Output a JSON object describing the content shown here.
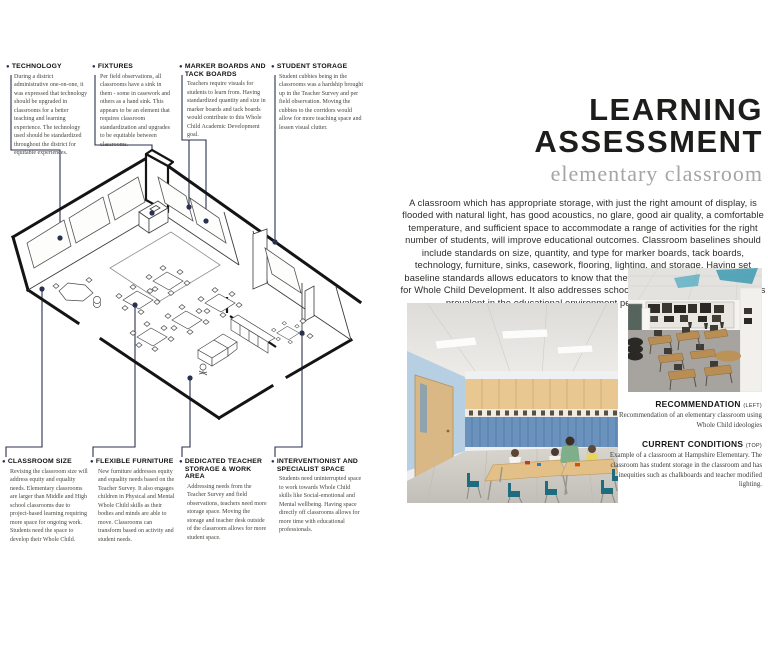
{
  "glyphs": {
    "bullet": "●"
  },
  "colors": {
    "accent_navy": "#2a3150",
    "title_black": "#1d1d1b",
    "subtitle_gray": "#a5a5a2",
    "locker_blue": "#6a92bd",
    "cabinet_wood": "#e8c890",
    "chair_teal": "#1f6b80"
  },
  "header": {
    "title_line1": "LEARNING",
    "title_line2": "ASSESSMENT",
    "subtitle": "elementary classroom"
  },
  "intro": {
    "text": "A classroom which has appropriate storage, with just the right amount of display, is flooded with natural light, has good acoustics, no glare, good air quality, a comfortable temperature, and sufficient space to accommodate a range of activities for the right number of students, will improve educational outcomes. Classroom baselines should include standards on size, quantity, and type for marker boards, tack boards, technology, furniture, sinks, casework, flooring, lighting, and storage. Having set baseline standards allows educators to know that they will have the space necessary for Whole Child Development. It also addresses school wide equity and equality issues prevalent in the educational environment per the Teacher Survey."
  },
  "diagram": {
    "top_callouts": [
      {
        "title": "TECHNOLOGY",
        "body": "During a district administrative one-on-one, it was expressed that technology should be upgraded in classrooms for a better teaching and learning experience. The technology used should be standardized throughout the district for equitable experiences."
      },
      {
        "title": "FIXTURES",
        "body": "Per field observations, all classrooms have a sink in them - some in casework and others as a hand sink. This appears to be an element that requires classroom standardization and upgrades to be equitable between classrooms."
      },
      {
        "title": "MARKER BOARDS AND TACK BOARDS",
        "body": "Teachers require visuals for students to learn from. Having standardized quantity and size in marker boards and tack boards would contribute to this Whole Child Academic Development goal."
      },
      {
        "title": "STUDENT STORAGE",
        "body": "Student cubbies being in the classrooms was a hardship brought up in the Teacher Survey and per field observation. Moving the cubbies to the corridors would allow for more teaching space and lessen visual clutter."
      }
    ],
    "bottom_callouts": [
      {
        "title": "CLASSROOM SIZE",
        "body": "Revising the classroom size will address equity and equality needs. Elementary classrooms are larger than Middle and High school classrooms due to project-based learning requiring more space for ongoing work. Students need the space to develop their Whole Child."
      },
      {
        "title": "FLEXIBLE FURNITURE",
        "body": "New furniture addresses equity and equality needs based on the Teacher Survey. It also engages children in Physical and Mental Whole Child skills as their bodies and minds are able to move. Classrooms can transform based on activity and student needs."
      },
      {
        "title": "DEDICATED TEACHER STORAGE & WORK AREA",
        "body": "Addressing needs from the Teacher Survey and field observations, teachers need more storage space. Moving the storage and teacher desk outside of the classroom allows for more student space."
      },
      {
        "title": "INTERVENTIONIST AND SPECIALIST SPACE",
        "body": "Students need uninterrupted space to work towards Whole Child skills like Social-emotional and Mental wellbeing. Having space directly off classrooms allows for more time with educational professionals."
      }
    ]
  },
  "captions": {
    "recommendation": {
      "title": "RECOMMENDATION",
      "tag": "(LEFT)",
      "body": "Recommendation of an elementary classroom using Whole Child ideologies"
    },
    "current": {
      "title": "CURRENT CONDITIONS",
      "tag": "(TOP)",
      "body": "Example of a classroom at Hampshire Elementary. The classroom has student storage in the classroom and has inequities such as chalkboards and teacher modified lighting."
    }
  }
}
